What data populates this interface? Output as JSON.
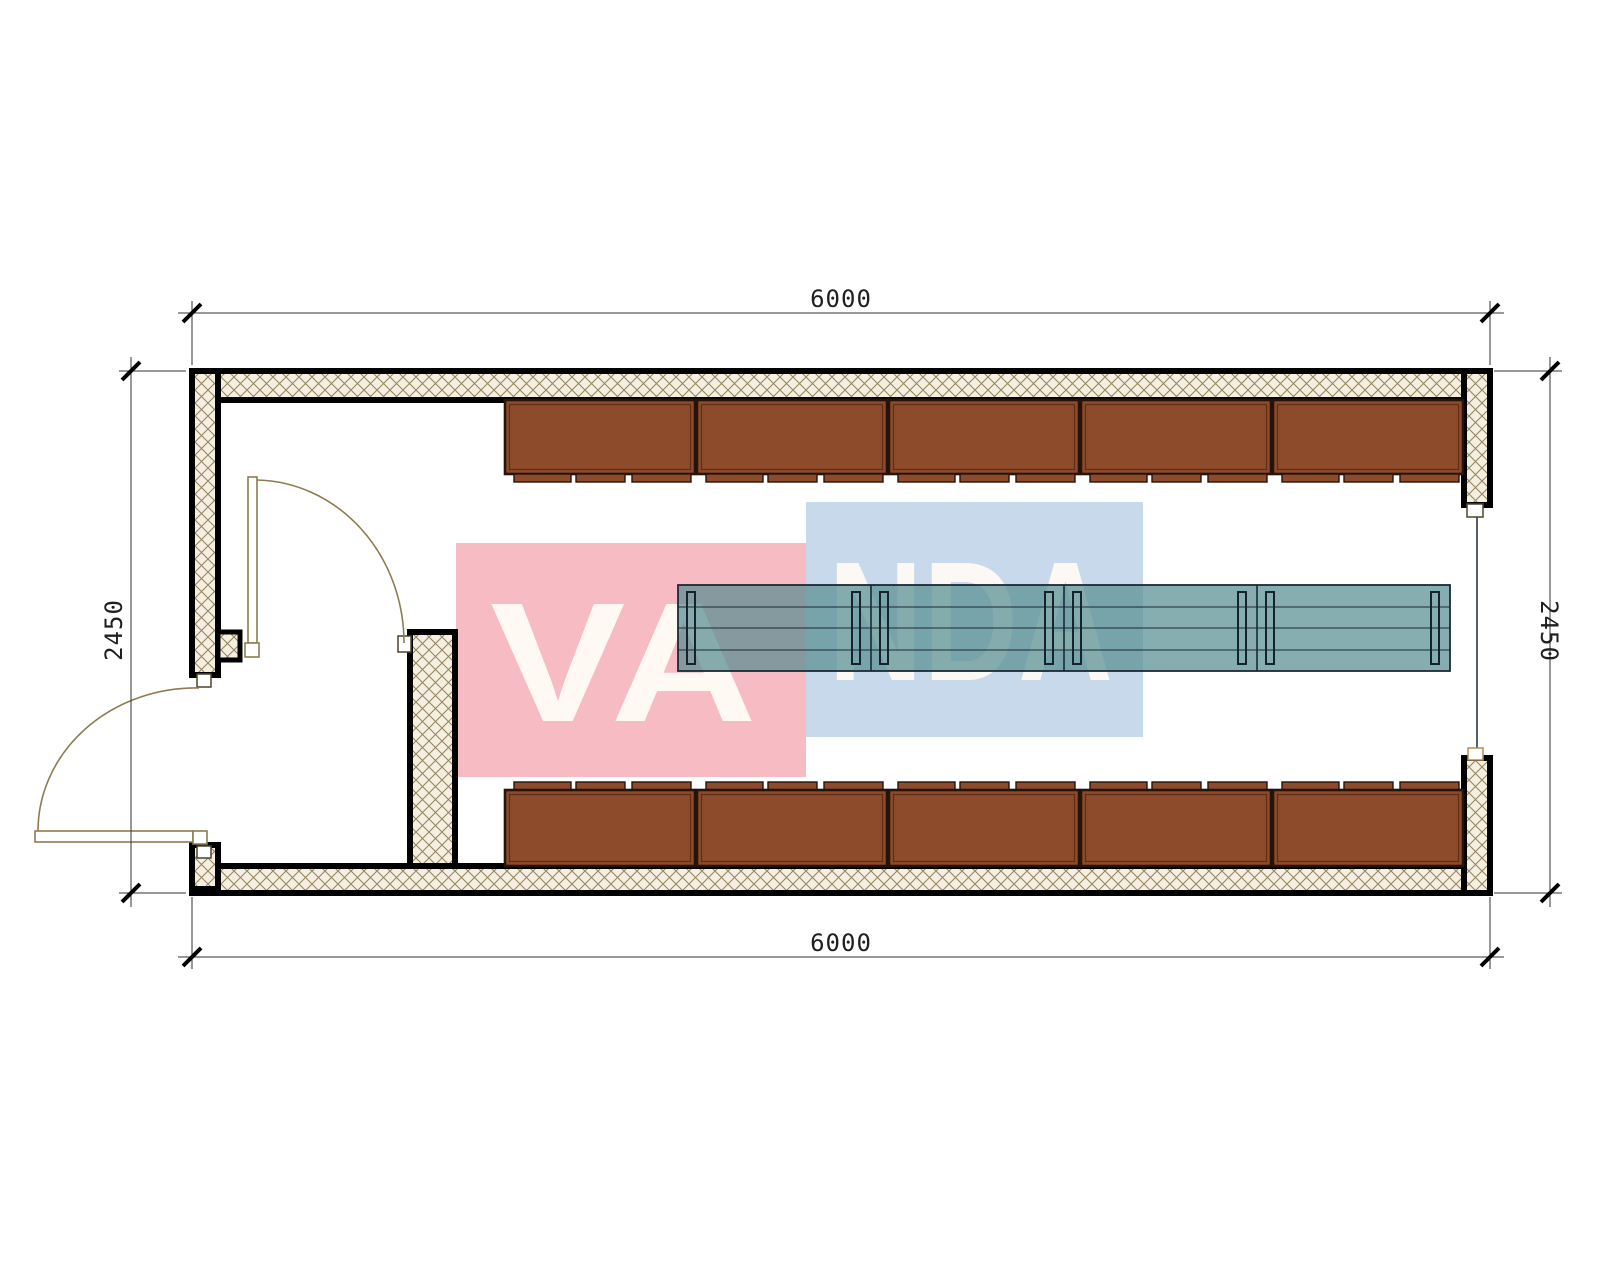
{
  "drawing": {
    "title": "container-floor-plan",
    "dimensions": {
      "top": "6000",
      "bottom": "6000",
      "left": "2450",
      "right": "2450"
    },
    "watermark": {
      "left_text": "VA",
      "right_text": "NDA",
      "full_text": "VANDA",
      "pink_color": "#f6bbc3",
      "blue_color": "#c9d9ec",
      "letter_color": "#fffbf5"
    },
    "counts": {
      "top_cabinets": 5,
      "bottom_cabinets": 5,
      "table_sections": 4,
      "doors": 2
    },
    "colors": {
      "wall_outline": "#000000",
      "wall_hatch_line": "#97875f",
      "wall_hatch_bg": "#f4efe1",
      "cabinet_fill": "#8d4b2b",
      "cabinet_border": "#26130a",
      "table_fill": "rgba(88,142,146,0.72)",
      "table_line": "#1b2a35",
      "door_line": "#8e7c50",
      "dimension_line": "#333333"
    }
  }
}
